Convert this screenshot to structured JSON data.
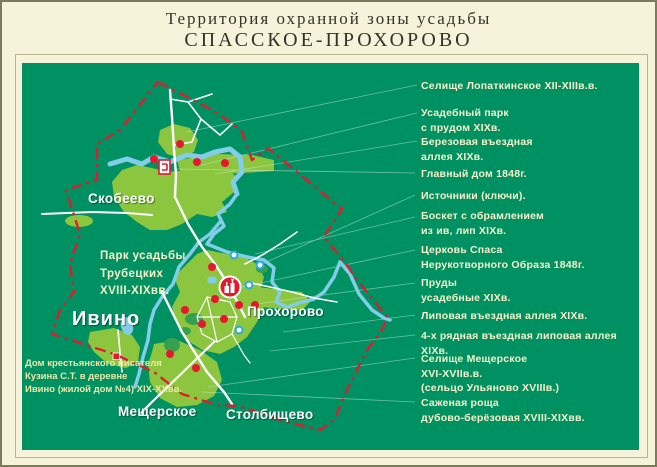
{
  "title": {
    "line1": "Территория охранной зоны усадьбы",
    "line2": "СПАССКОЕ-ПРОХОРОВО"
  },
  "map": {
    "villages": [
      {
        "label": "Скобеево"
      },
      {
        "label": "Ивино"
      },
      {
        "label": "Прохорово"
      },
      {
        "label": "Мещерское"
      },
      {
        "label": "Столбищево"
      }
    ],
    "notes": {
      "park": "Парк усадьбы\nТрубецких\nXVIII-XIXвв.",
      "kuzin_house": "Дом крестьянского писателя\nКузина С.Т. в деревне\nИвино (жилой дом №4) XIX-XXвв."
    },
    "markers": {
      "church": "church-icon",
      "main_house": "main-house-icon",
      "kuzin_house": "house-square-icon",
      "heritage_point": "red-dot-icon",
      "spring": "spring-icon",
      "boundary": "dash-dot-boundary-line"
    }
  },
  "legend": {
    "items": [
      {
        "label": "Селище Лопаткинское XII-XIIIв.в."
      },
      {
        "label": "Усадебный парк\nс прудом XIXв."
      },
      {
        "label": "Березовая въездная\nаллея XIXв."
      },
      {
        "label": "Главный дом 1848г."
      },
      {
        "label": "Источники (ключи)."
      },
      {
        "label": "Боскет с обрамлением\nиз ив, лип XIXв."
      },
      {
        "label": "Церковь Спаса\nНерукотворного Образа 1848г."
      },
      {
        "label": "Пруды\nусадебные XIXв."
      },
      {
        "label": "Липовая въездная аллея XIXв."
      },
      {
        "label": "4-х рядная въездная липовая аллея XIXв."
      },
      {
        "label": "Селище Мещерское\nXVI-XVIIв.в.\n(сельцо Ульяново XVIIIв.)"
      },
      {
        "label": "Саженая роща\nдубово-берёзовая XVIII-XIXвв."
      }
    ]
  },
  "colors": {
    "background": "#f6f3da",
    "panel_green": "#009163",
    "area_green": "#8cc63f",
    "grove_green": "#35a14f",
    "river_blue": "#82cdea",
    "boundary_red": "#e5182e",
    "road_white": "#ffffff",
    "legend_text": "#f7f0c8",
    "note_text": "#efe7a6"
  }
}
